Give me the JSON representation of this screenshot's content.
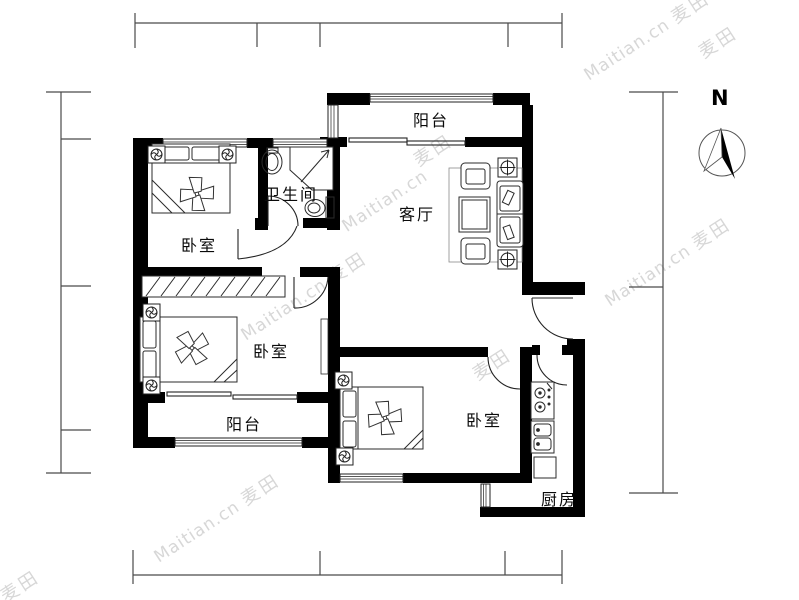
{
  "watermark": {
    "brand": "Maitian.cn",
    "logo": "麦田"
  },
  "compass": {
    "north": "N"
  },
  "rooms": {
    "balcony_north": {
      "label": "阳台"
    },
    "bathroom": {
      "label": "卫生间"
    },
    "living_room": {
      "label": "客厅"
    },
    "bedroom_northwest": {
      "label": "卧室"
    },
    "bedroom_west": {
      "label": "卧室"
    },
    "balcony_south": {
      "label": "阳台"
    },
    "bedroom_southeast": {
      "label": "卧室"
    },
    "kitchen": {
      "label": "厨房"
    }
  },
  "colors": {
    "wall": "#000000",
    "furniture_line": "#2b2b2b",
    "dimension_line": "#4a4a4a",
    "watermark": "#d7d7d7",
    "background": "#ffffff"
  }
}
